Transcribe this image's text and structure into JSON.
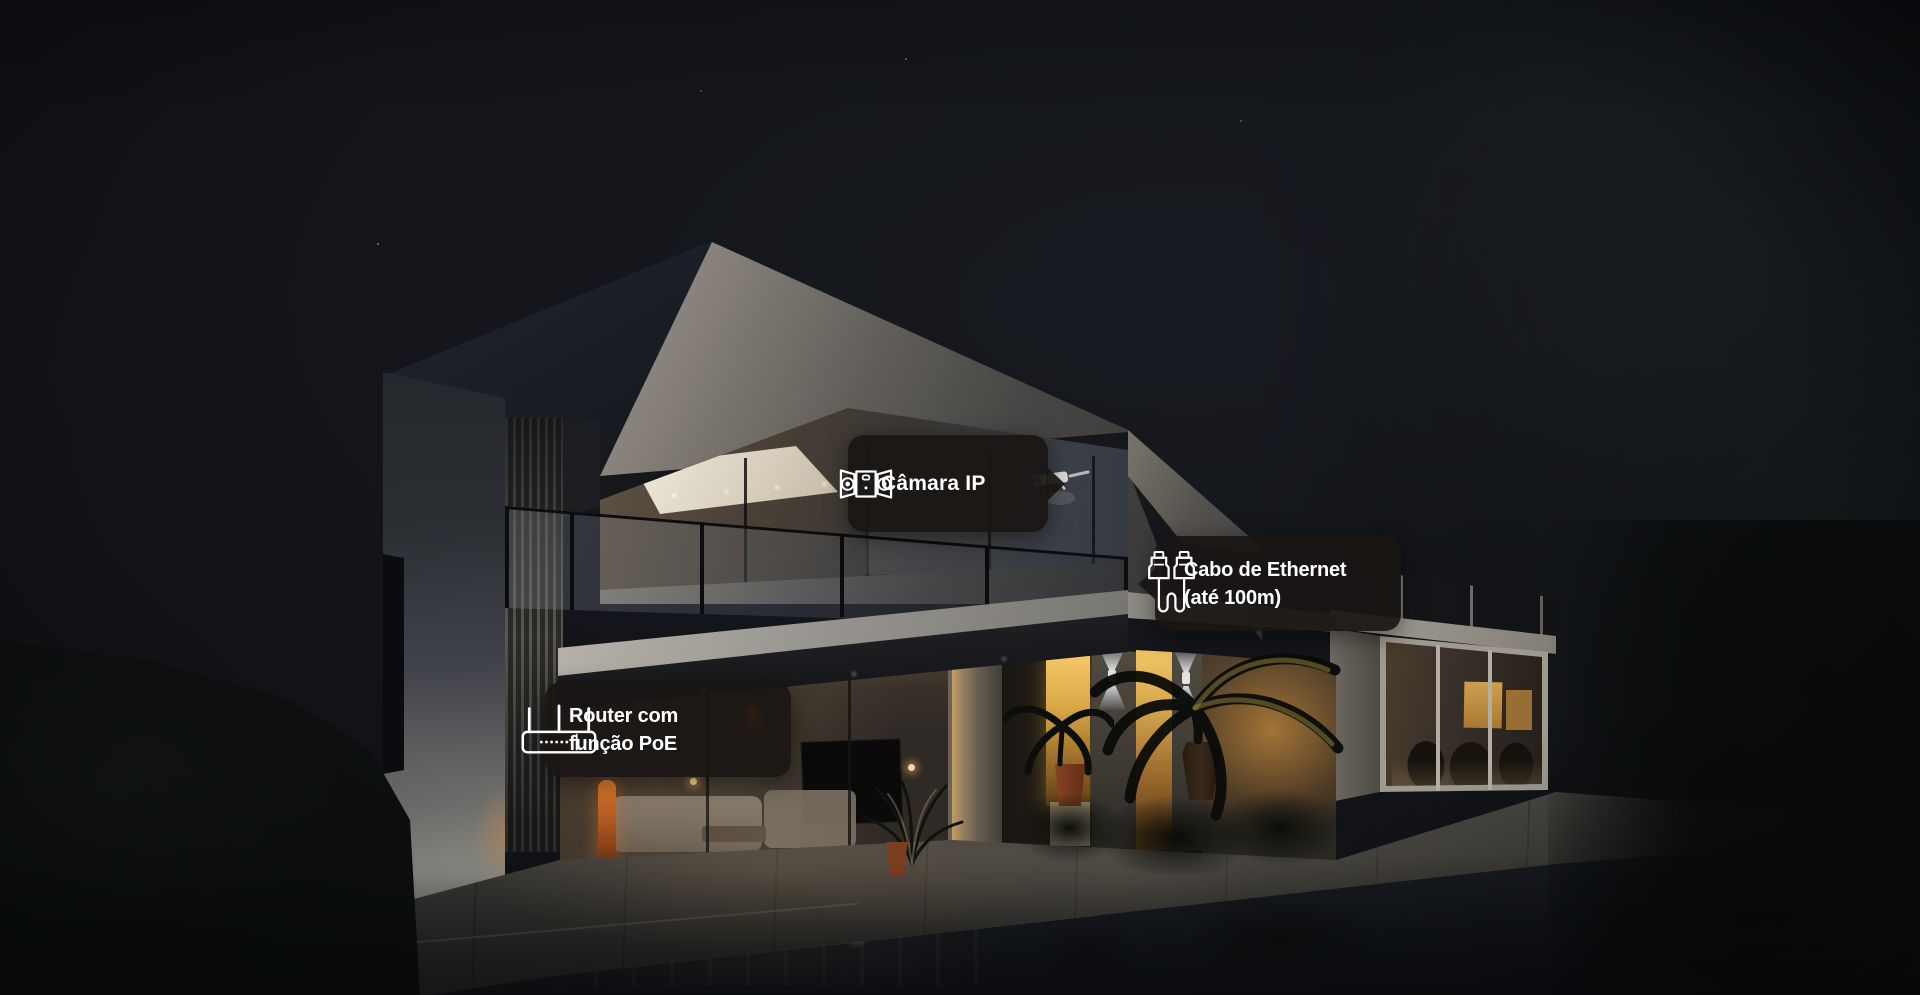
{
  "callouts": {
    "camera": {
      "label": "Câmara IP",
      "icon": "ip-camera-icon",
      "arrow_direction": "right"
    },
    "ethernet": {
      "line1": "Cabo de Ethernet",
      "line2": "(até 100m)",
      "icon": "ethernet-cable-icon",
      "arrow_direction": "left"
    },
    "router": {
      "line1": "Router com",
      "line2": "função PoE",
      "icon": "poe-router-icon",
      "arrow_direction": "none"
    }
  },
  "colors": {
    "callout_background": "rgba(25,22,19,0.93)",
    "callout_text": "#ffffff",
    "night_sky": "#13151a",
    "interior_warm_light": "#e8b455",
    "garden_glow": "#e09a3c"
  }
}
